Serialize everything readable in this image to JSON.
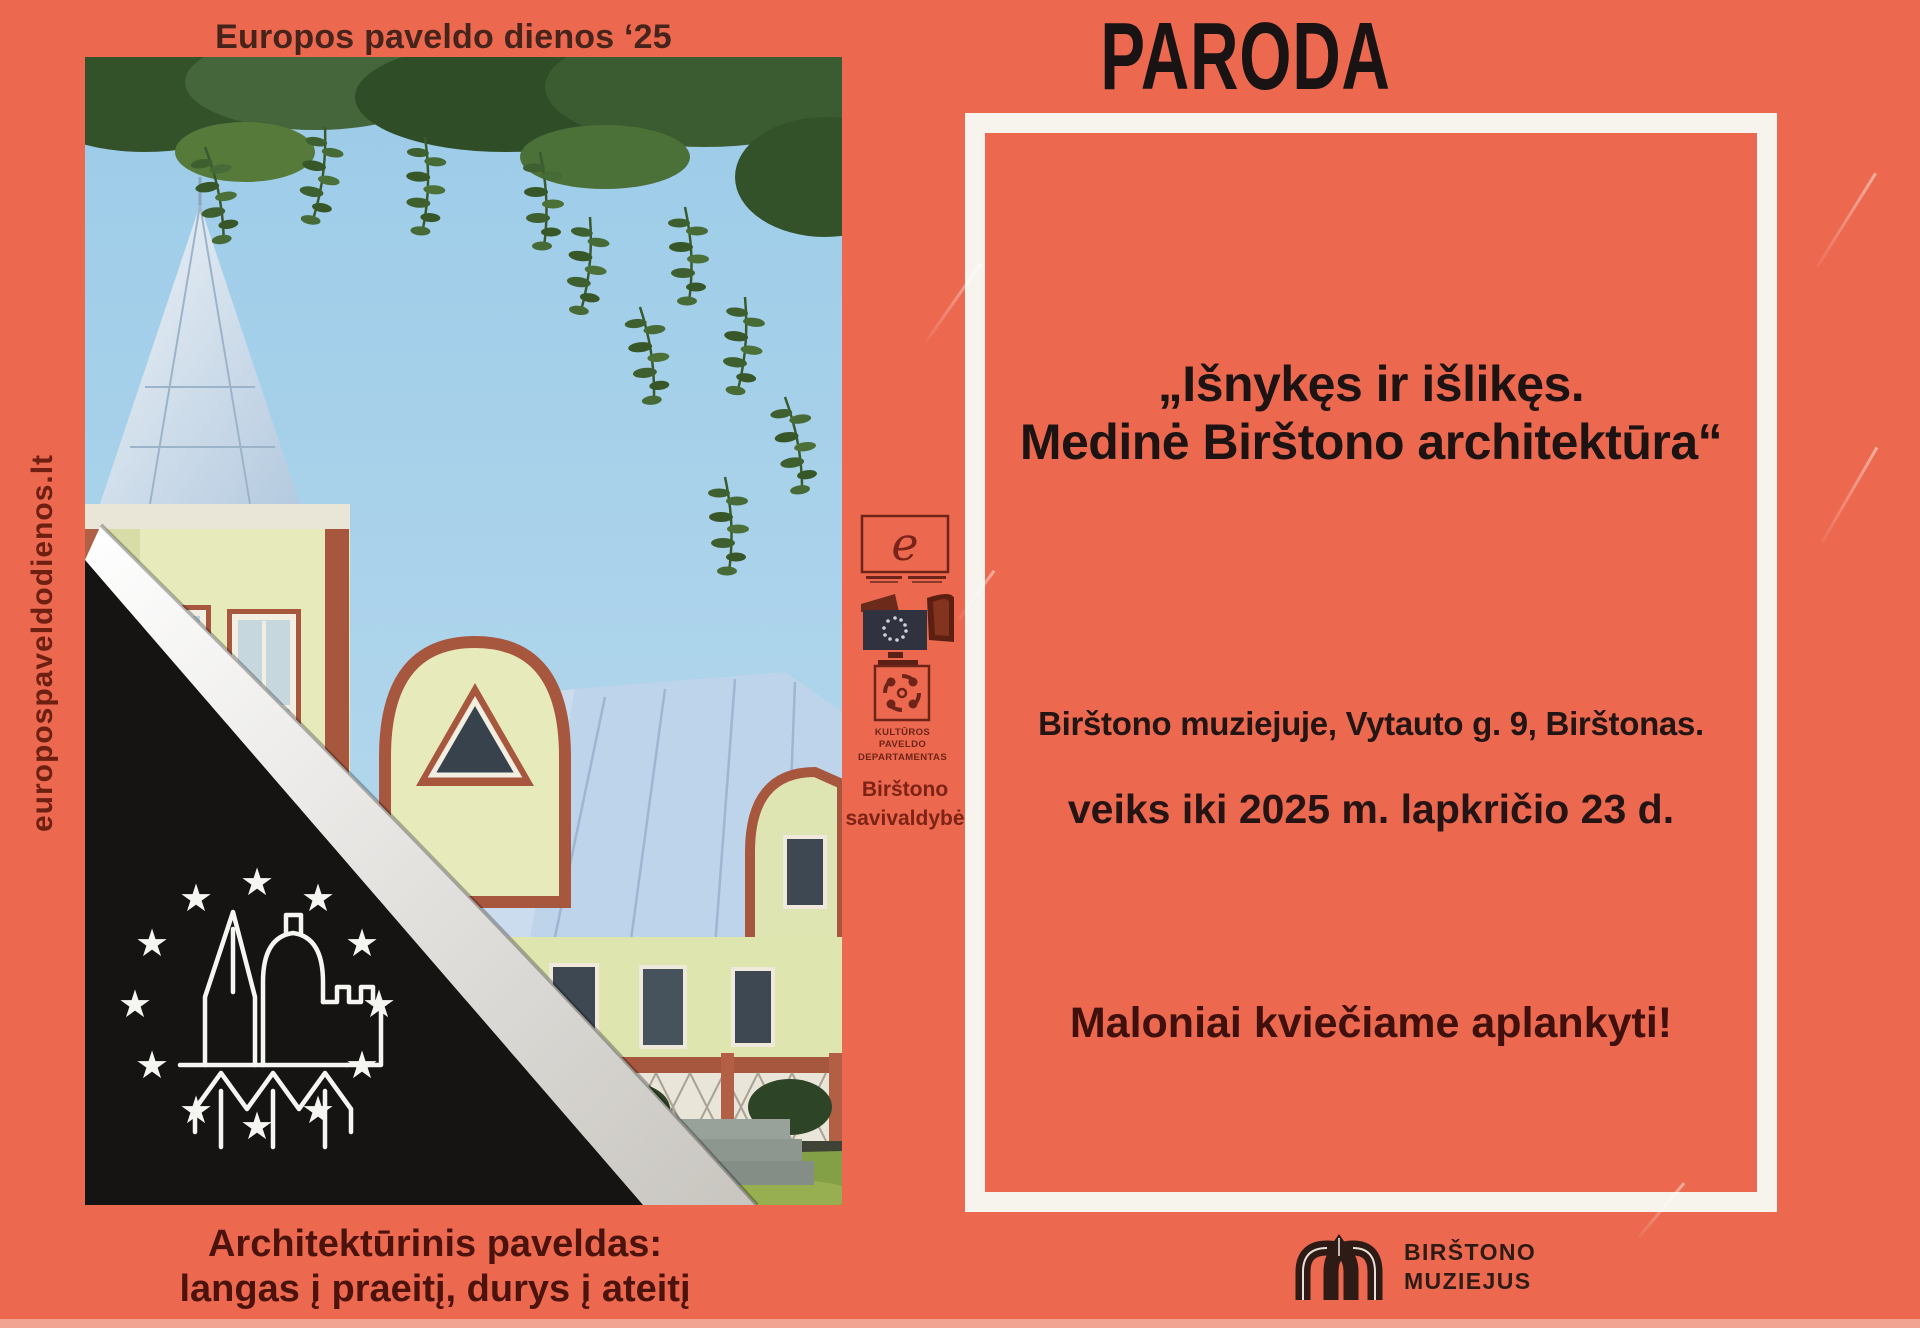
{
  "poster": {
    "header_left": "Europos paveldo dienos ‘25",
    "header_right": "PARODA",
    "vertical_link": "europospaveldodienos.lt",
    "caption_line1": "Architektūrinis paveldas:",
    "caption_line2": "langas į praeitį, durys į ateitį"
  },
  "exhibition": {
    "title_line1": "„Išnykęs ir išlikęs.",
    "title_line2": "Medinė Birštono architektūra“",
    "venue": "Birštono muziejuje, Vytauto g. 9, Birštonas.",
    "date_info": "veiks iki 2025 m. lapkričio 23 d.",
    "invitation": "Maloniai kviečiame aplankyti!"
  },
  "partners": {
    "dept_line1": "KULTŪROS",
    "dept_line2": "PAVELDO",
    "dept_line3": "DEPARTAMENTAS",
    "municipality_line1": "Birštono",
    "municipality_line2": "savivaldybė"
  },
  "museum": {
    "name_line1": "BIRŠTONO",
    "name_line2": "MUZIEJUS"
  },
  "icons": {
    "star": "★",
    "coe_e": "e"
  },
  "colors": {
    "background": "#ec6950",
    "frame_white": "#f7f4ee",
    "ink_black": "#1a1413",
    "maroon_text": "#5f1a10",
    "corner_black": "#161413"
  }
}
